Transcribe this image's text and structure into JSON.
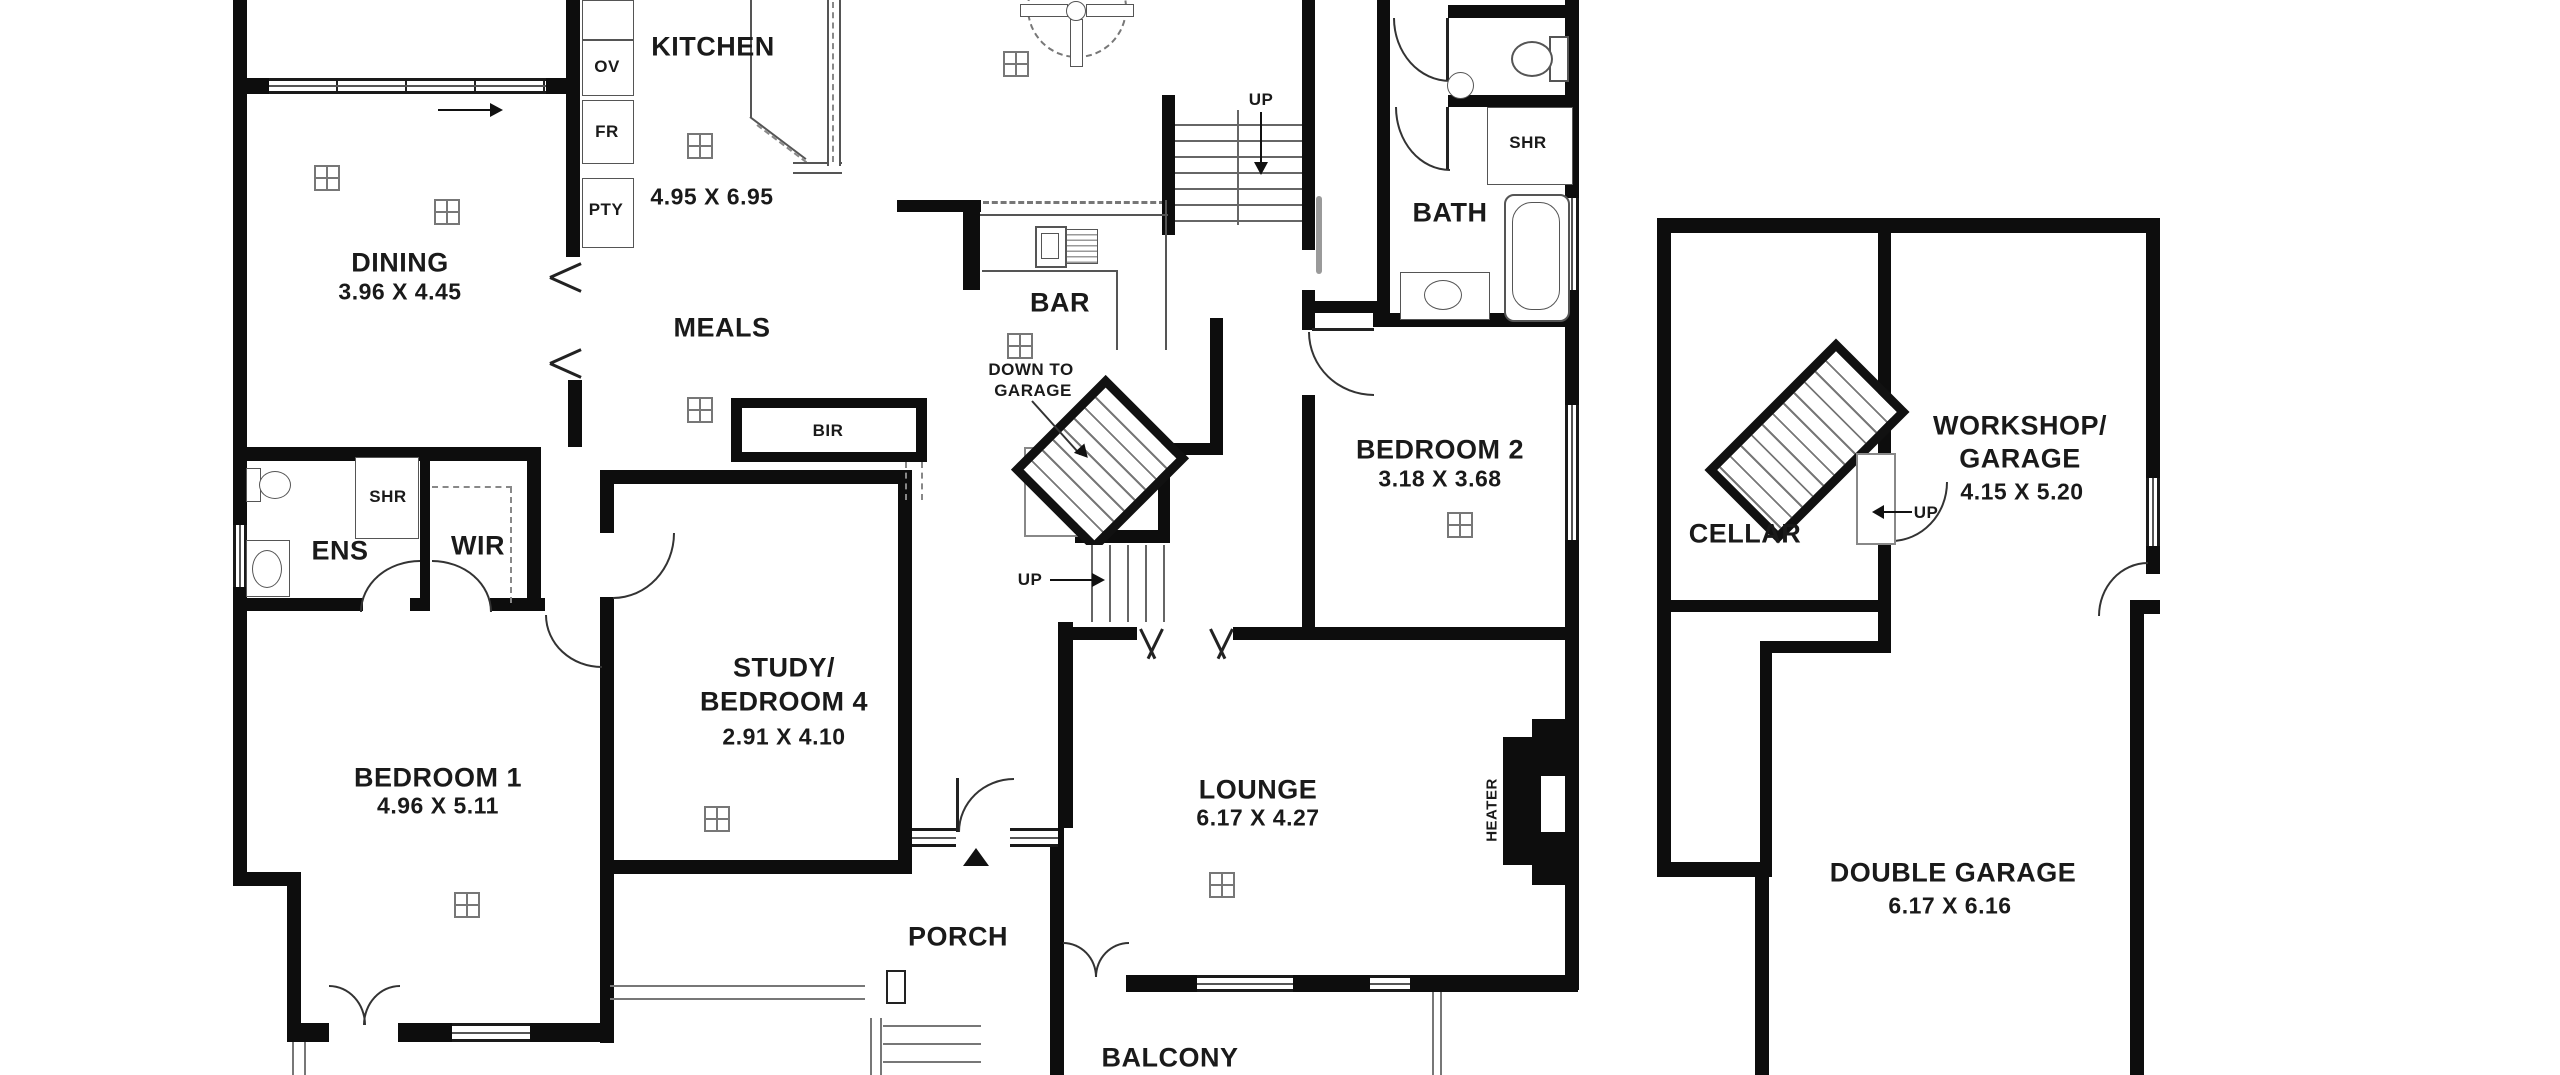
{
  "plan_type": "floor-plan",
  "rooms": {
    "kitchen": {
      "name": "KITCHEN",
      "dims": "4.95 X 6.95"
    },
    "dining": {
      "name": "DINING",
      "dims": "3.96 X 4.45"
    },
    "meals": {
      "name": "MEALS"
    },
    "bar": {
      "name": "BAR"
    },
    "bath": {
      "name": "BATH"
    },
    "bedroom2": {
      "name": "BEDROOM 2",
      "dims": "3.18 X 3.68"
    },
    "ens": {
      "name": "ENS"
    },
    "wir": {
      "name": "WIR"
    },
    "bedroom1": {
      "name": "BEDROOM 1",
      "dims": "4.96 X 5.11"
    },
    "study": {
      "line1": "STUDY/",
      "line2": "BEDROOM 4",
      "dims": "2.91 X 4.10"
    },
    "porch": {
      "name": "PORCH"
    },
    "lounge": {
      "name": "LOUNGE",
      "dims": "6.17 X 4.27"
    },
    "balcony": {
      "name": "BALCONY"
    },
    "cellar": {
      "name": "CELLAR"
    },
    "workshop": {
      "line1": "WORKSHOP/",
      "line2": "GARAGE",
      "dims": "4.15 X 5.20"
    },
    "double_garage": {
      "name": "DOUBLE GARAGE",
      "dims": "6.17 X 6.16"
    }
  },
  "labels": {
    "oven": "OV",
    "fridge": "FR",
    "pantry": "PTY",
    "shower_ens": "SHR",
    "shower_bath": "SHR",
    "built_in_robe": "BIR",
    "heater": "HEATER"
  },
  "stairs": {
    "up_main": "UP",
    "up_entry": "UP",
    "up_cellar": "UP",
    "down_to_garage_line1": "DOWN TO",
    "down_to_garage_line2": "GARAGE"
  },
  "colors": {
    "background": "#ffffff",
    "wall": "#0d0d0d",
    "thin_line": "#555555",
    "text": "#1a1a1a"
  }
}
